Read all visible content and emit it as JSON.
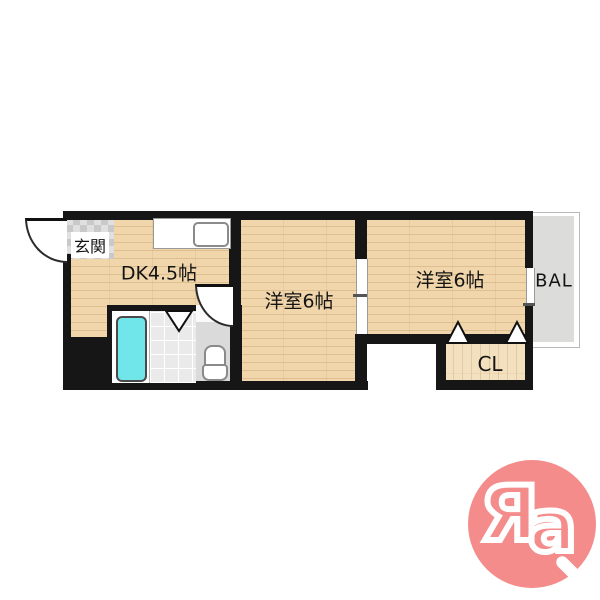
{
  "colors": {
    "wall": "#161616",
    "wood": "#F0D6AA",
    "wood-light": "#F3E0BE",
    "tub": "#70E6EA",
    "tile": "#EAEAEA",
    "genkan-tile": "#E0E0E0",
    "toilet-floor": "#DADADA",
    "balcony": "#DCDCDA",
    "logo-pink": "#F48C8C"
  },
  "rooms": {
    "genkan": {
      "label": "玄関"
    },
    "dk": {
      "label": "DK4.5帖"
    },
    "bedroom_center": {
      "label": "洋室6帖"
    },
    "bedroom_right": {
      "label": "洋室6帖"
    },
    "closet": {
      "label": "CL"
    },
    "balcony": {
      "label": "BAL"
    }
  },
  "logo": {
    "letter_r": "Я",
    "letter_a": "a"
  }
}
